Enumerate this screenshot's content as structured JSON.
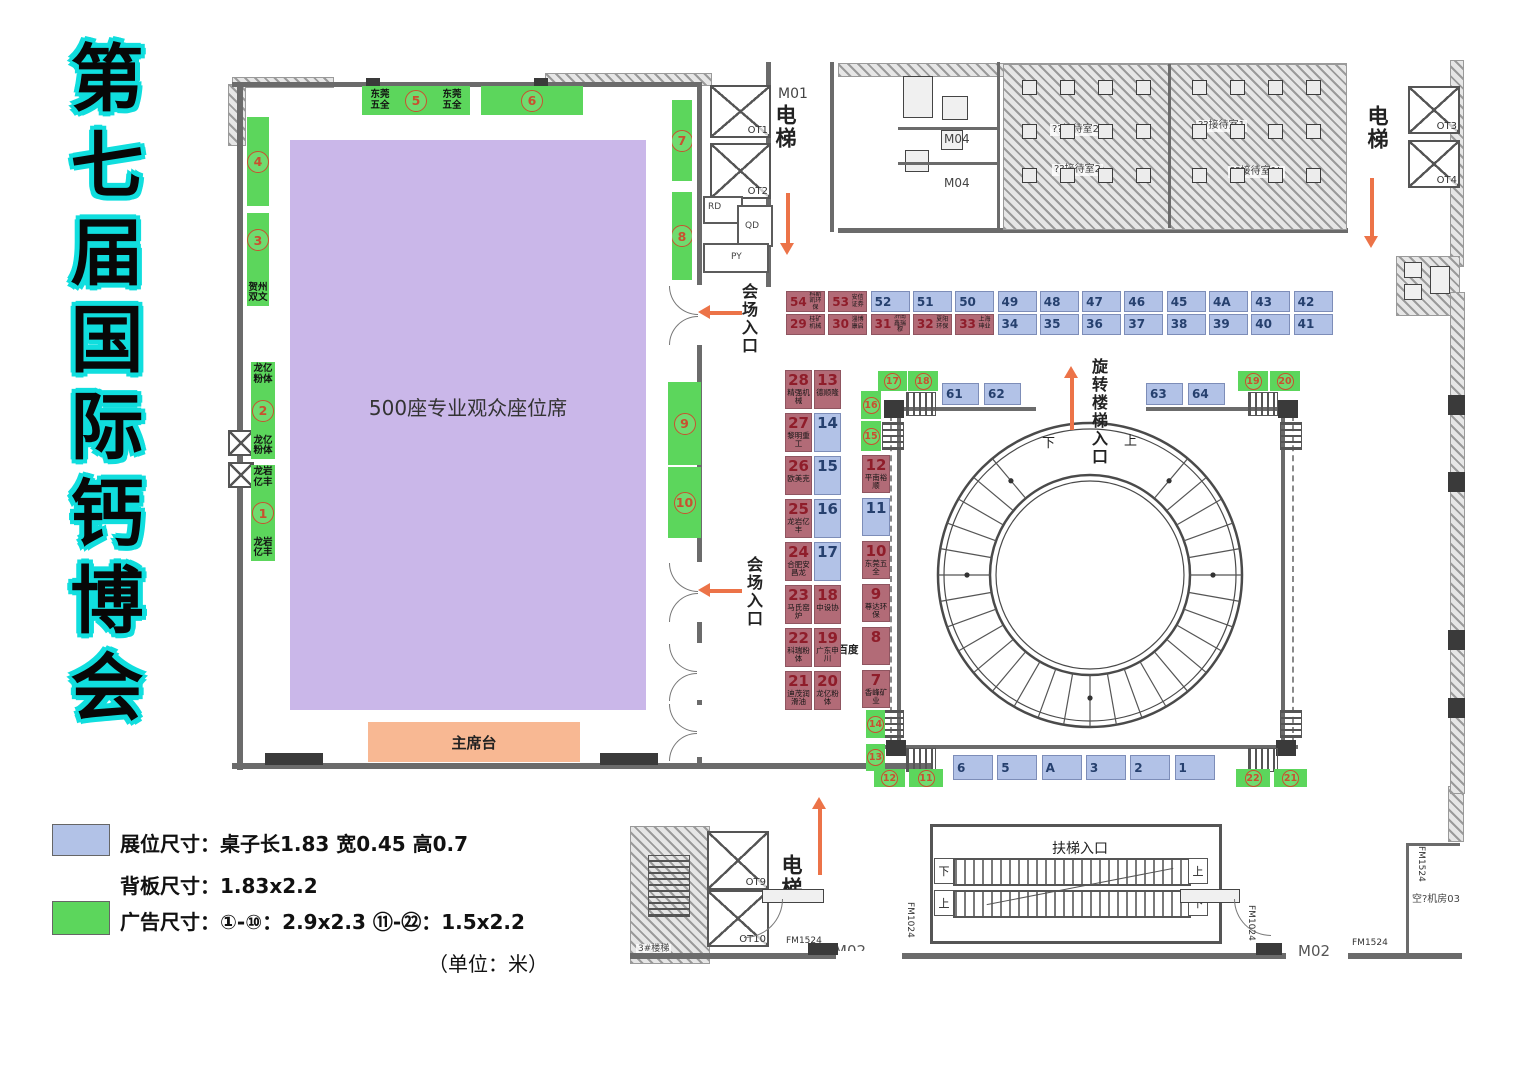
{
  "title": "第七届国际钙博会",
  "hall": {
    "seating": "500座专业观众座位席",
    "stage": "主席台",
    "entrance_a": "会场入口",
    "entrance_b": "会场入口",
    "ads": {
      "a1": {
        "num": "1",
        "above": "龙岩亿丰",
        "below": "龙岩亿丰"
      },
      "a2": {
        "num": "2",
        "above": "龙亿粉体",
        "below": "龙亿粉体"
      },
      "a3": {
        "num": "3",
        "below": "贺州双文"
      },
      "a4": {
        "num": "4"
      },
      "a5": {
        "num": "5",
        "left": "东莞五全",
        "right": "东莞五全"
      },
      "a6": {
        "num": "6"
      },
      "a7": {
        "num": "7"
      },
      "a8": {
        "num": "8"
      },
      "a9": {
        "num": "9"
      },
      "a10": {
        "num": "10"
      }
    }
  },
  "circle_area": {
    "spiral_entrance": "旋转楼梯入口",
    "down": "下",
    "up": "上",
    "side_note": "千百度",
    "ads": {
      "n11": "11",
      "n12": "12",
      "n13": "13",
      "n14": "14",
      "n15": "15",
      "n16": "16",
      "n17": "17",
      "n18": "18",
      "n19": "19",
      "n20": "20",
      "n21": "21",
      "n22": "22"
    }
  },
  "booths": {
    "top_row_1": [
      {
        "n": "54",
        "name": "科斯凯环保"
      },
      {
        "n": "53",
        "name": "安信证券"
      },
      {
        "n": "52"
      },
      {
        "n": "51"
      },
      {
        "n": "50"
      },
      {
        "n": "49"
      },
      {
        "n": "48"
      },
      {
        "n": "47"
      },
      {
        "n": "46"
      },
      {
        "n": "45"
      },
      {
        "n": "4A"
      },
      {
        "n": "43"
      },
      {
        "n": "42"
      }
    ],
    "top_row_2": [
      {
        "n": "29",
        "name": "桂矿机械"
      },
      {
        "n": "30",
        "name": "淄博康启"
      },
      {
        "n": "31",
        "name": "济南鑫瑞穆"
      },
      {
        "n": "32",
        "name": "夏阳环保"
      },
      {
        "n": "33",
        "name": "上海珅业"
      },
      {
        "n": "34"
      },
      {
        "n": "35"
      },
      {
        "n": "36"
      },
      {
        "n": "37"
      },
      {
        "n": "38"
      },
      {
        "n": "39"
      },
      {
        "n": "40"
      },
      {
        "n": "41"
      }
    ],
    "mid_rows": [
      [
        {
          "n": "28",
          "name": "精强机械"
        },
        {
          "n": "13",
          "name": "德顺隆"
        }
      ],
      [
        {
          "n": "27",
          "name": "黎明重工"
        },
        {
          "n": "14"
        }
      ],
      [
        {
          "n": "26",
          "name": "欧美克"
        },
        {
          "n": "15"
        }
      ],
      [
        {
          "n": "25",
          "name": "龙岩亿丰"
        },
        {
          "n": "16"
        }
      ],
      [
        {
          "n": "24",
          "name": "合肥安昌龙"
        },
        {
          "n": "17"
        }
      ],
      [
        {
          "n": "23",
          "name": "马氏窑炉"
        },
        {
          "n": "18",
          "name": "中设协"
        }
      ],
      [
        {
          "n": "22",
          "name": "科瑞粉体"
        },
        {
          "n": "19",
          "name": "广东申川"
        }
      ],
      [
        {
          "n": "21",
          "name": "迪茂润滑油"
        },
        {
          "n": "20",
          "name": "龙亿粉体"
        }
      ]
    ],
    "side_col": [
      {
        "n": "12",
        "name": "平南裕顺"
      },
      {
        "n": "11"
      },
      {
        "n": "10",
        "name": "东莞五全"
      },
      {
        "n": "9",
        "name": "尊达环保"
      },
      {
        "n": "8",
        "r": 1
      },
      {
        "n": "7",
        "name": "香峰矿业"
      }
    ],
    "upper_left": [
      {
        "n": "61"
      },
      {
        "n": "62"
      }
    ],
    "upper_right": [
      {
        "n": "63"
      },
      {
        "n": "64"
      }
    ],
    "bottom_row": [
      {
        "n": "6"
      },
      {
        "n": "5"
      },
      {
        "n": "A"
      },
      {
        "n": "3"
      },
      {
        "n": "2"
      },
      {
        "n": "1"
      }
    ]
  },
  "escalator": {
    "label": "扶梯入口",
    "lane1_left": "下",
    "lane1_right": "上",
    "lane2_left": "上",
    "lane2_right": "下"
  },
  "labels": {
    "m01": "M01",
    "m04_a": "M04",
    "m04_b": "M04",
    "elevator_top": "电梯",
    "elevator_right": "电梯",
    "elevator_bottom": "电梯",
    "rd": "RD",
    "qd": "QD",
    "py": "PY",
    "ot1": "OT1",
    "ot2": "OT2",
    "ot3": "OT3",
    "ot4": "OT4",
    "ot9": "OT9",
    "ot10": "OT10",
    "reception_1": "??接待室2",
    "reception_2": "??接待室1",
    "reception_3": "??接待室2",
    "reception_4": "??接待室1L",
    "stairs": "3#楼梯",
    "machine_room": "空?机房03",
    "m02_a": "M02",
    "m02_b": "M02",
    "fm1524_a": "FM1524",
    "fm1024_a": "FM1024",
    "fm1024_b": "FM1024",
    "fm1524_b": "FM1524",
    "fm1524_c": "FM1524"
  },
  "legend": {
    "booth_size": "展位尺寸：桌子长1.83 宽0.45 高0.7",
    "panel_size": "背板尺寸：1.83x2.2",
    "ad_size": "广告尺寸：①-⑩：2.9x2.3 ⑪-㉒：1.5x2.2",
    "unit": "（单位：米）"
  },
  "colors": {
    "booth_blue": "#b2c2e7",
    "booth_red": "#b26b77",
    "ad_green": "#5cd65c",
    "seating_purple": "#cab7e9",
    "stage_orange": "#f8b893",
    "arrow_orange": "#ec7348",
    "title_glow": "#10dede"
  }
}
